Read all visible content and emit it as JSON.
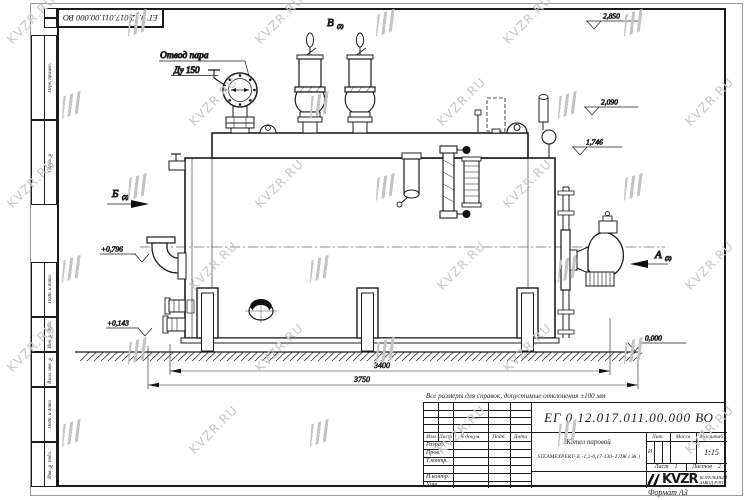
{
  "doc_number": "ЕГ 0.12.017.011.00.000  ВО",
  "frame_labels": {
    "perv": "Перв. примен.",
    "sprav": "Справ. №",
    "podp1": "Подп. и дата",
    "inv_dubl": "Инв. № дубл.",
    "vzam": "Взам. инв. №",
    "podp2": "Подп. и дата",
    "inv_podl": "Инв. № подл.",
    "format": "Формат А3"
  },
  "note": "Все размеры для справок, допустимые отклонения ±100 мм",
  "drawing": {
    "labels": {
      "steam_outlet_1": "Отвод пара",
      "steam_outlet_2": "Ду 150",
      "view_b": "Б",
      "view_v": "В",
      "view_a": "А",
      "view_sub": "(2)"
    },
    "levels": {
      "l1": "2,850",
      "l2": "2,090",
      "l3": "1,746",
      "l4": "+0,796",
      "l5": "+0,143",
      "l6": "0,000"
    },
    "dims": {
      "d1": "3400",
      "d2": "3750"
    }
  },
  "title_block": {
    "doc_number": "ЕГ 0.12.017.011.00.000  ВО",
    "name_line1": "Котел паровой",
    "name_line2": "STEAMEXPERT- Е -1,2-0,17-130- ГЛЖ ( Ж )",
    "cols": {
      "izm": "Изм",
      "list": "Лист",
      "ndoc": "N докум.",
      "podp": "Подп.",
      "data": "Дата"
    },
    "rows": {
      "razrab": "Разраб.",
      "prov": "Пров.",
      "tkontr": "Т.контр.",
      "nkontr": "Н.контр.",
      "utv": "Утв."
    },
    "lit_label": "Лит.",
    "mass_label": "Масса",
    "scale_label": "Масштаб",
    "lit_value": "И",
    "scale_value": "1:15",
    "sheet_label": "Лист",
    "sheet_value": "1",
    "sheets_label": "Листов",
    "sheets_value": "2",
    "logo_text": "KVZR",
    "logo_sub1": "КОТЕЛЬНЫЙ",
    "logo_sub2": "ЗАВОД РЭП"
  },
  "watermark": {
    "text": "KVZR.RU"
  }
}
